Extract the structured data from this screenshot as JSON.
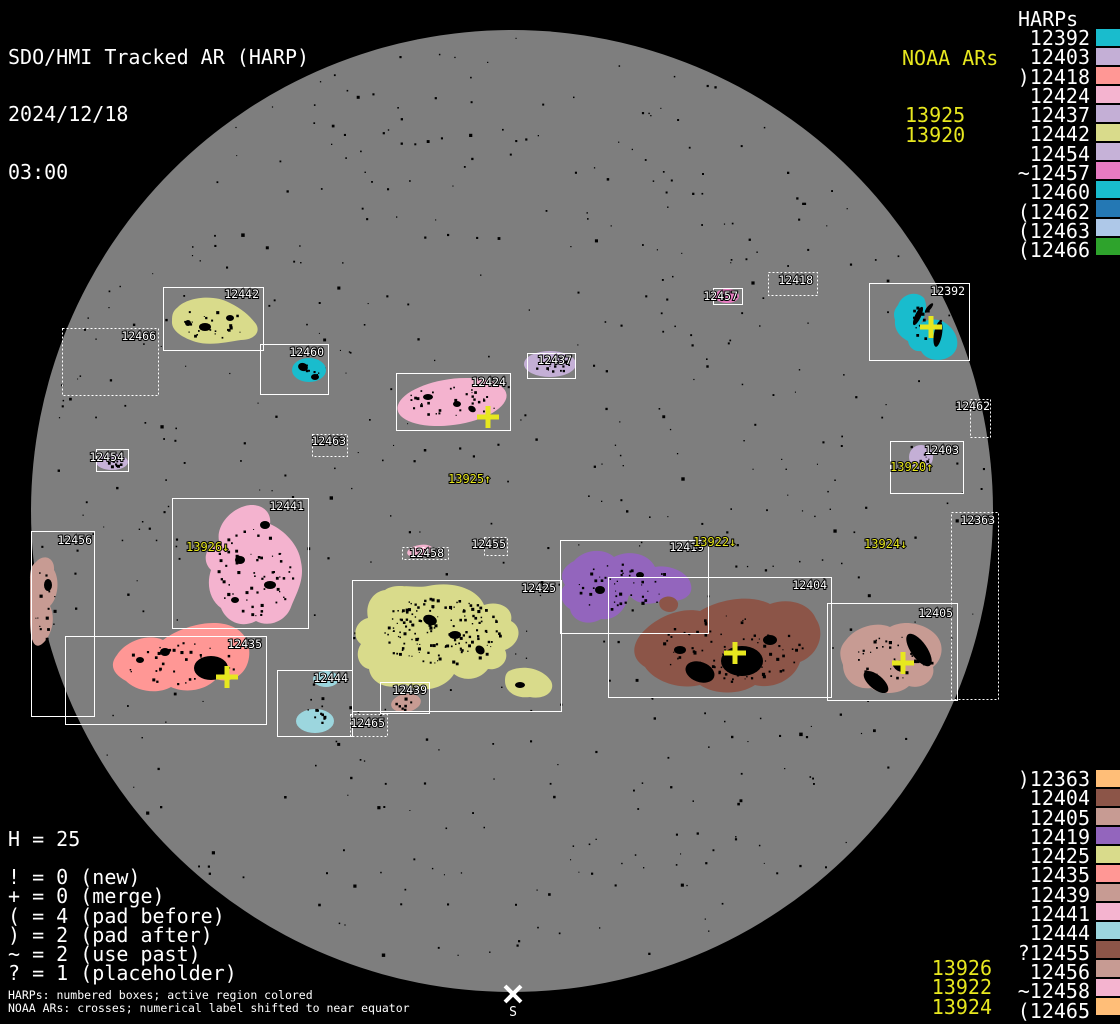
{
  "title": {
    "app": "SDO/HMI Tracked AR (HARP)",
    "date": "2024/12/18",
    "time": "03:00"
  },
  "colors": {
    "background": "#000000",
    "disk": "#7e7e7e",
    "box_stroke": "#ffffff",
    "label_text": "#ffffff",
    "noaa_text": "#e7e71f",
    "speck": "#000000"
  },
  "legend_top": {
    "noaa_title": "NOAA ARs",
    "noaa_items": [
      "13925",
      "13920"
    ],
    "harps_title": "HARPs",
    "harp_items": [
      {
        "label": "12392",
        "color": "#19bccd"
      },
      {
        "label": "12403",
        "color": "#c4afd6"
      },
      {
        "label": ")12418",
        "color": "#ff9795"
      },
      {
        "label": "12424",
        "color": "#f4b3cf"
      },
      {
        "label": "12437",
        "color": "#c4afd6"
      },
      {
        "label": "12442",
        "color": "#d9db8b"
      },
      {
        "label": "12454",
        "color": "#c6b2d8"
      },
      {
        "label": "~12457",
        "color": "#e77bc1"
      },
      {
        "label": "12460",
        "color": "#19bccd"
      },
      {
        "label": "(12462",
        "color": "#2478b4"
      },
      {
        "label": "(12463",
        "color": "#aec8e8"
      },
      {
        "label": "(12466",
        "color": "#2ea32c"
      }
    ]
  },
  "legend_bottom": {
    "harp_items": [
      {
        "label": ")12363",
        "color": "#ffbe78"
      },
      {
        "label": "12404",
        "color": "#8c5548"
      },
      {
        "label": "12405",
        "color": "#c79b93"
      },
      {
        "label": "12419",
        "color": "#9365bd"
      },
      {
        "label": "12425",
        "color": "#d9db8b"
      },
      {
        "label": "12435",
        "color": "#ff9795"
      },
      {
        "label": "12439",
        "color": "#c79b93"
      },
      {
        "label": "12441",
        "color": "#f4b3cf"
      },
      {
        "label": "12444",
        "color": "#9cd6de"
      },
      {
        "label": "?12455",
        "color": "#8c5548"
      },
      {
        "label": "12456",
        "color": "#c79b93"
      },
      {
        "label": "~12458",
        "color": "#f4b3cf"
      },
      {
        "label": "(12465",
        "color": "#ffbe78"
      }
    ],
    "noaa_items": [
      "13926",
      "13922",
      "13924"
    ]
  },
  "stats": {
    "header": "H = 25",
    "lines": [
      "! = 0 (new)",
      "+ = 0 (merge)",
      "( = 4 (pad before)",
      ") = 2 (pad after)",
      "~ = 2 (use past)",
      "? = 1 (placeholder)"
    ]
  },
  "footnotes": [
    "HARPs: numbered boxes; active region colored",
    "NOAA ARs: crosses; numerical label shifted to near equator"
  ],
  "south_marker": {
    "x": 513,
    "y": 994,
    "label": "S"
  },
  "chart_data": {
    "type": "scatter",
    "title": "SDO/HMI Tracked AR (HARP) 2024/12/18 03:00",
    "disk": {
      "cx": 512,
      "cy": 511,
      "r": 481
    },
    "regions": [
      {
        "harp": "12442",
        "color": "#d9db8b",
        "box": [
          163,
          287,
          100,
          63
        ],
        "dotted": false,
        "label": [
          259,
          298
        ],
        "blob": "M178,307 C188,297 214,294 230,303 C242,309 250,316 256,324 C261,332 254,340 241,340 C228,342 210,346 196,342 C183,338 171,331 172,321 C172,314 173,311 178,307 Z",
        "noise": [
          215,
          322,
          38,
          16,
          26
        ],
        "spots": [
          [
            205,
            327,
            6,
            4,
            0
          ],
          [
            230,
            318,
            4,
            3,
            0
          ],
          [
            188,
            323,
            3,
            3,
            0
          ]
        ]
      },
      {
        "harp": "12466",
        "color": null,
        "box": [
          62,
          328,
          96,
          67
        ],
        "dotted": true,
        "label": [
          156,
          340
        ]
      },
      {
        "harp": "12460",
        "color": "#19bccd",
        "box": [
          260,
          344,
          68,
          50
        ],
        "dotted": false,
        "label": [
          324,
          356
        ],
        "blob": "ellipse:309,370,17,12,0",
        "noise": [
          309,
          370,
          13,
          8,
          8
        ],
        "spots": [
          [
            303,
            367,
            5,
            4,
            20
          ],
          [
            315,
            377,
            4,
            3,
            0
          ]
        ]
      },
      {
        "harp": "12424",
        "color": "#f4b3cf",
        "box": [
          396,
          373,
          114,
          57
        ],
        "dotted": false,
        "label": [
          506,
          386
        ],
        "blob": "ellipse:452,402,55,23,-8",
        "noise": [
          452,
          401,
          46,
          16,
          32
        ],
        "spots": [
          [
            428,
            397,
            5,
            3,
            0
          ],
          [
            457,
            404,
            4,
            3,
            0
          ],
          [
            472,
            409,
            4,
            3,
            30
          ]
        ]
      },
      {
        "harp": "12437",
        "color": "#c4afd6",
        "box": [
          527,
          353,
          48,
          25
        ],
        "dotted": false,
        "label": [
          572,
          364
        ],
        "blob": "ellipse:550,364,26,13,0",
        "noise": [
          550,
          364,
          20,
          8,
          14
        ]
      },
      {
        "harp": "12463",
        "color": null,
        "box": [
          312,
          434,
          35,
          22
        ],
        "dotted": true,
        "label": [
          346,
          445
        ]
      },
      {
        "harp": "12454",
        "color": "#c6b2d8",
        "box": [
          96,
          449,
          32,
          22
        ],
        "dotted": false,
        "label": [
          124,
          461
        ],
        "blob": "ellipse:112,462,16,8,0",
        "noise": [
          112,
          462,
          13,
          6,
          10
        ]
      },
      {
        "harp": "12457",
        "color": "#e77bc1",
        "box": [
          713,
          288,
          29,
          16
        ],
        "dotted": false,
        "label": [
          738,
          300
        ],
        "blob": "ellipse:727,296,12,7,0",
        "noise": [
          727,
          296,
          9,
          4,
          6
        ]
      },
      {
        "harp": "12418",
        "color": null,
        "box": [
          768,
          272,
          49,
          23
        ],
        "dotted": true,
        "label": [
          813,
          284
        ]
      },
      {
        "harp": "12392",
        "color": "#19bccd",
        "box": [
          869,
          283,
          100,
          77
        ],
        "dotted": false,
        "label": [
          965,
          295
        ],
        "blob": "M898,305 C902,294 916,290 924,298 C928,306 926,316 921,323 C929,318 941,318 948,325 C958,333 961,347 952,355 C942,363 926,361 921,351 C915,352 909,348 908,341 C900,337 894,330 895,320 C893,314 894,310 898,305 Z",
        "noise": [
          928,
          325,
          26,
          24,
          12
        ],
        "spots": [
          [
            918,
            316,
            3,
            10,
            25
          ],
          [
            938,
            334,
            4,
            13,
            10
          ],
          [
            929,
            308,
            2,
            6,
            40
          ]
        ]
      },
      {
        "harp": "12462",
        "color": null,
        "box": [
          970,
          399,
          20,
          38
        ],
        "dotted": true,
        "label": [
          990,
          410
        ]
      },
      {
        "harp": "12403",
        "color": "#c4afd6",
        "box": [
          890,
          441,
          73,
          52
        ],
        "dotted": false,
        "label": [
          959,
          454
        ],
        "blob": "ellipse:921,457,12,12,0",
        "noise": [
          921,
          457,
          8,
          8,
          8
        ]
      },
      {
        "harp": "12441",
        "color": "#f4b3cf",
        "box": [
          172,
          498,
          136,
          130
        ],
        "dotted": false,
        "label": [
          304,
          510
        ],
        "blob": "M245,506 C260,502 272,511 270,524 C284,530 299,545 301,562 C305,580 296,594 291,607 C286,621 269,628 256,621 C241,629 226,621 221,608 C210,600 206,585 211,570 C201,560 206,546 219,541 C216,526 230,510 245,506 Z",
        "noise": [
          255,
          570,
          40,
          46,
          60
        ],
        "spots": [
          [
            265,
            525,
            5,
            4,
            0
          ],
          [
            240,
            560,
            5,
            4,
            0
          ],
          [
            270,
            585,
            6,
            4,
            0
          ],
          [
            235,
            600,
            4,
            3,
            0
          ]
        ]
      },
      {
        "harp": "12456",
        "color": "#c79b93",
        "box": [
          31,
          531,
          63,
          185
        ],
        "dotted": false,
        "label": [
          92,
          544
        ],
        "blob": "M36,562 C44,553 55,558 54,570 C60,580 58,598 50,606 C56,618 52,636 42,644 C34,650 30,640 30,620 L30,580 C30,570 31,566 36,562 Z",
        "noise": [
          45,
          600,
          13,
          38,
          16
        ],
        "spots": [
          [
            48,
            585,
            4,
            6,
            0
          ]
        ]
      },
      {
        "harp": "12435",
        "color": "#ff9795",
        "box": [
          65,
          636,
          201,
          88
        ],
        "dotted": false,
        "label": [
          262,
          648
        ],
        "blob": "M117,655 C126,641 148,633 163,640 C180,627 211,618 231,626 C247,632 252,648 248,662 C244,676 230,684 216,679 C206,690 186,694 171,687 C157,695 136,691 126,681 C113,674 109,665 117,655 Z",
        "noise": [
          180,
          662,
          56,
          22,
          40
        ],
        "spots": [
          [
            211,
            668,
            17,
            12,
            0
          ],
          [
            165,
            652,
            5,
            4,
            0
          ],
          [
            140,
            660,
            4,
            3,
            0
          ]
        ]
      },
      {
        "harp": "12444",
        "color": "#9cd6de",
        "box": [
          277,
          670,
          75,
          66
        ],
        "dotted": false,
        "label": [
          348,
          682
        ],
        "blob": "ellipse:326,679,13,8,0|ellipse:315,721,19,12,0",
        "noise": [
          317,
          714,
          14,
          9,
          10
        ]
      },
      {
        "harp": "12465",
        "color": null,
        "box": [
          350,
          714,
          37,
          22
        ],
        "dotted": true,
        "label": [
          385,
          727
        ]
      },
      {
        "harp": "12425",
        "color": "#d9db8b",
        "box": [
          352,
          580,
          209,
          131
        ],
        "dotted": false,
        "label": [
          556,
          592
        ],
        "blob": "M428,586 C458,580 479,592 484,605 C499,600 514,608 511,621 C524,628 519,645 505,650 C510,660 500,671 488,669 C480,680 464,682 454,674 C444,690 419,694 405,684 C389,691 371,684 369,669 C359,667 354,654 361,644 C351,637 355,621 368,618 C365,605 372,592 385,590 C396,582 414,589 428,586 Z M509,671 C524,664 543,669 551,681 C556,691 545,700 530,697 C515,699 505,691 505,681 C505,676 506,673 509,671 Z",
        "noise": [
          440,
          630,
          60,
          36,
          150
        ],
        "spots": [
          [
            430,
            620,
            7,
            5,
            20
          ],
          [
            455,
            635,
            6,
            4,
            0
          ],
          [
            480,
            650,
            5,
            4,
            40
          ],
          [
            520,
            685,
            5,
            3,
            0
          ]
        ]
      },
      {
        "harp": "12439",
        "color": "#c79b93",
        "box": [
          380,
          682,
          49,
          31
        ],
        "dotted": false,
        "label": [
          427,
          694
        ],
        "blob": "ellipse:406,703,15,9,-10",
        "noise": [
          406,
          703,
          11,
          6,
          8
        ]
      },
      {
        "harp": "12458",
        "color": "#f4b3cf",
        "box": [
          402,
          547,
          46,
          12
        ],
        "dotted": true,
        "label": [
          444,
          557
        ],
        "blob": "ellipse:420,551,13,6,-10",
        "noise": [
          420,
          551,
          10,
          4,
          5
        ]
      },
      {
        "harp": "12455",
        "color": null,
        "box": [
          484,
          537,
          23,
          18
        ],
        "dotted": true,
        "label": [
          506,
          548
        ]
      },
      {
        "harp": "12419",
        "color": "#9365bd",
        "box": [
          560,
          540,
          148,
          93
        ],
        "dotted": false,
        "label": [
          704,
          551
        ],
        "blob": "M574,561 C583,550 603,547 614,557 C629,549 649,554 655,567 C669,564 689,572 691,585 C694,597 679,604 665,599 C651,607 636,604 629,595 C626,609 616,621 601,619 C588,627 572,621 570,609 C561,604 558,592 565,585 C558,575 564,566 574,561 Z",
        "noise": [
          620,
          585,
          50,
          26,
          45
        ],
        "spots": [
          [
            600,
            590,
            5,
            4,
            0
          ],
          [
            640,
            575,
            4,
            3,
            0
          ]
        ]
      },
      {
        "harp": "12404",
        "color": "#8c5548",
        "box": [
          608,
          577,
          223,
          120
        ],
        "dotted": false,
        "label": [
          827,
          589
        ],
        "blob": "M641,634 C656,617 680,607 700,611 C720,599 750,594 770,604 C790,597 810,604 816,619 C826,634 818,655 800,662 C795,678 775,690 755,685 C740,695 715,695 700,685 C680,690 655,682 645,667 C632,659 631,647 641,634 Z M660,600 C666,594 676,596 678,603 C679,610 672,614 665,611 C660,609 658,604 660,600 Z",
        "noise": [
          730,
          648,
          72,
          34,
          90
        ],
        "spots": [
          [
            742,
            661,
            21,
            15,
            0
          ],
          [
            700,
            672,
            15,
            10,
            20
          ],
          [
            770,
            640,
            7,
            5,
            0
          ],
          [
            680,
            650,
            6,
            4,
            0
          ]
        ]
      },
      {
        "harp": "12405",
        "color": "#c79b93",
        "box": [
          827,
          603,
          130,
          97
        ],
        "dotted": false,
        "label": [
          953,
          617
        ],
        "blob": "M846,640 C856,627 876,621 890,627 C905,619 925,624 935,634 C945,644 943,659 933,667 C936,679 923,690 909,686 C899,695 881,695 871,688 C856,690 843,680 843,665 C839,655 839,648 846,640 Z",
        "noise": [
          893,
          658,
          40,
          22,
          40
        ],
        "spots": [
          [
            919,
            650,
            19,
            8,
            55
          ],
          [
            876,
            682,
            15,
            7,
            40
          ],
          [
            898,
            666,
            7,
            4,
            45
          ]
        ]
      },
      {
        "harp": "12363",
        "color": null,
        "box": [
          951,
          512,
          47,
          187
        ],
        "dotted": true,
        "label": [
          995,
          524
        ]
      }
    ],
    "crosses": [
      {
        "noaa": "13925",
        "x": 488,
        "y": 417
      },
      {
        "noaa": "13920",
        "x": 931,
        "y": 327
      },
      {
        "noaa": "13926",
        "x": 227,
        "y": 677
      },
      {
        "noaa": "13922",
        "x": 735,
        "y": 653
      },
      {
        "noaa": "13924",
        "x": 903,
        "y": 663
      }
    ],
    "noaa_disk_labels": [
      {
        "text": "13925↑",
        "x": 448,
        "y": 483
      },
      {
        "text": "13920↑",
        "x": 890,
        "y": 471
      },
      {
        "text": "13926↓",
        "x": 186,
        "y": 551
      },
      {
        "text": "13922↓",
        "x": 693,
        "y": 546
      },
      {
        "text": "13924↓",
        "x": 864,
        "y": 548
      }
    ]
  }
}
